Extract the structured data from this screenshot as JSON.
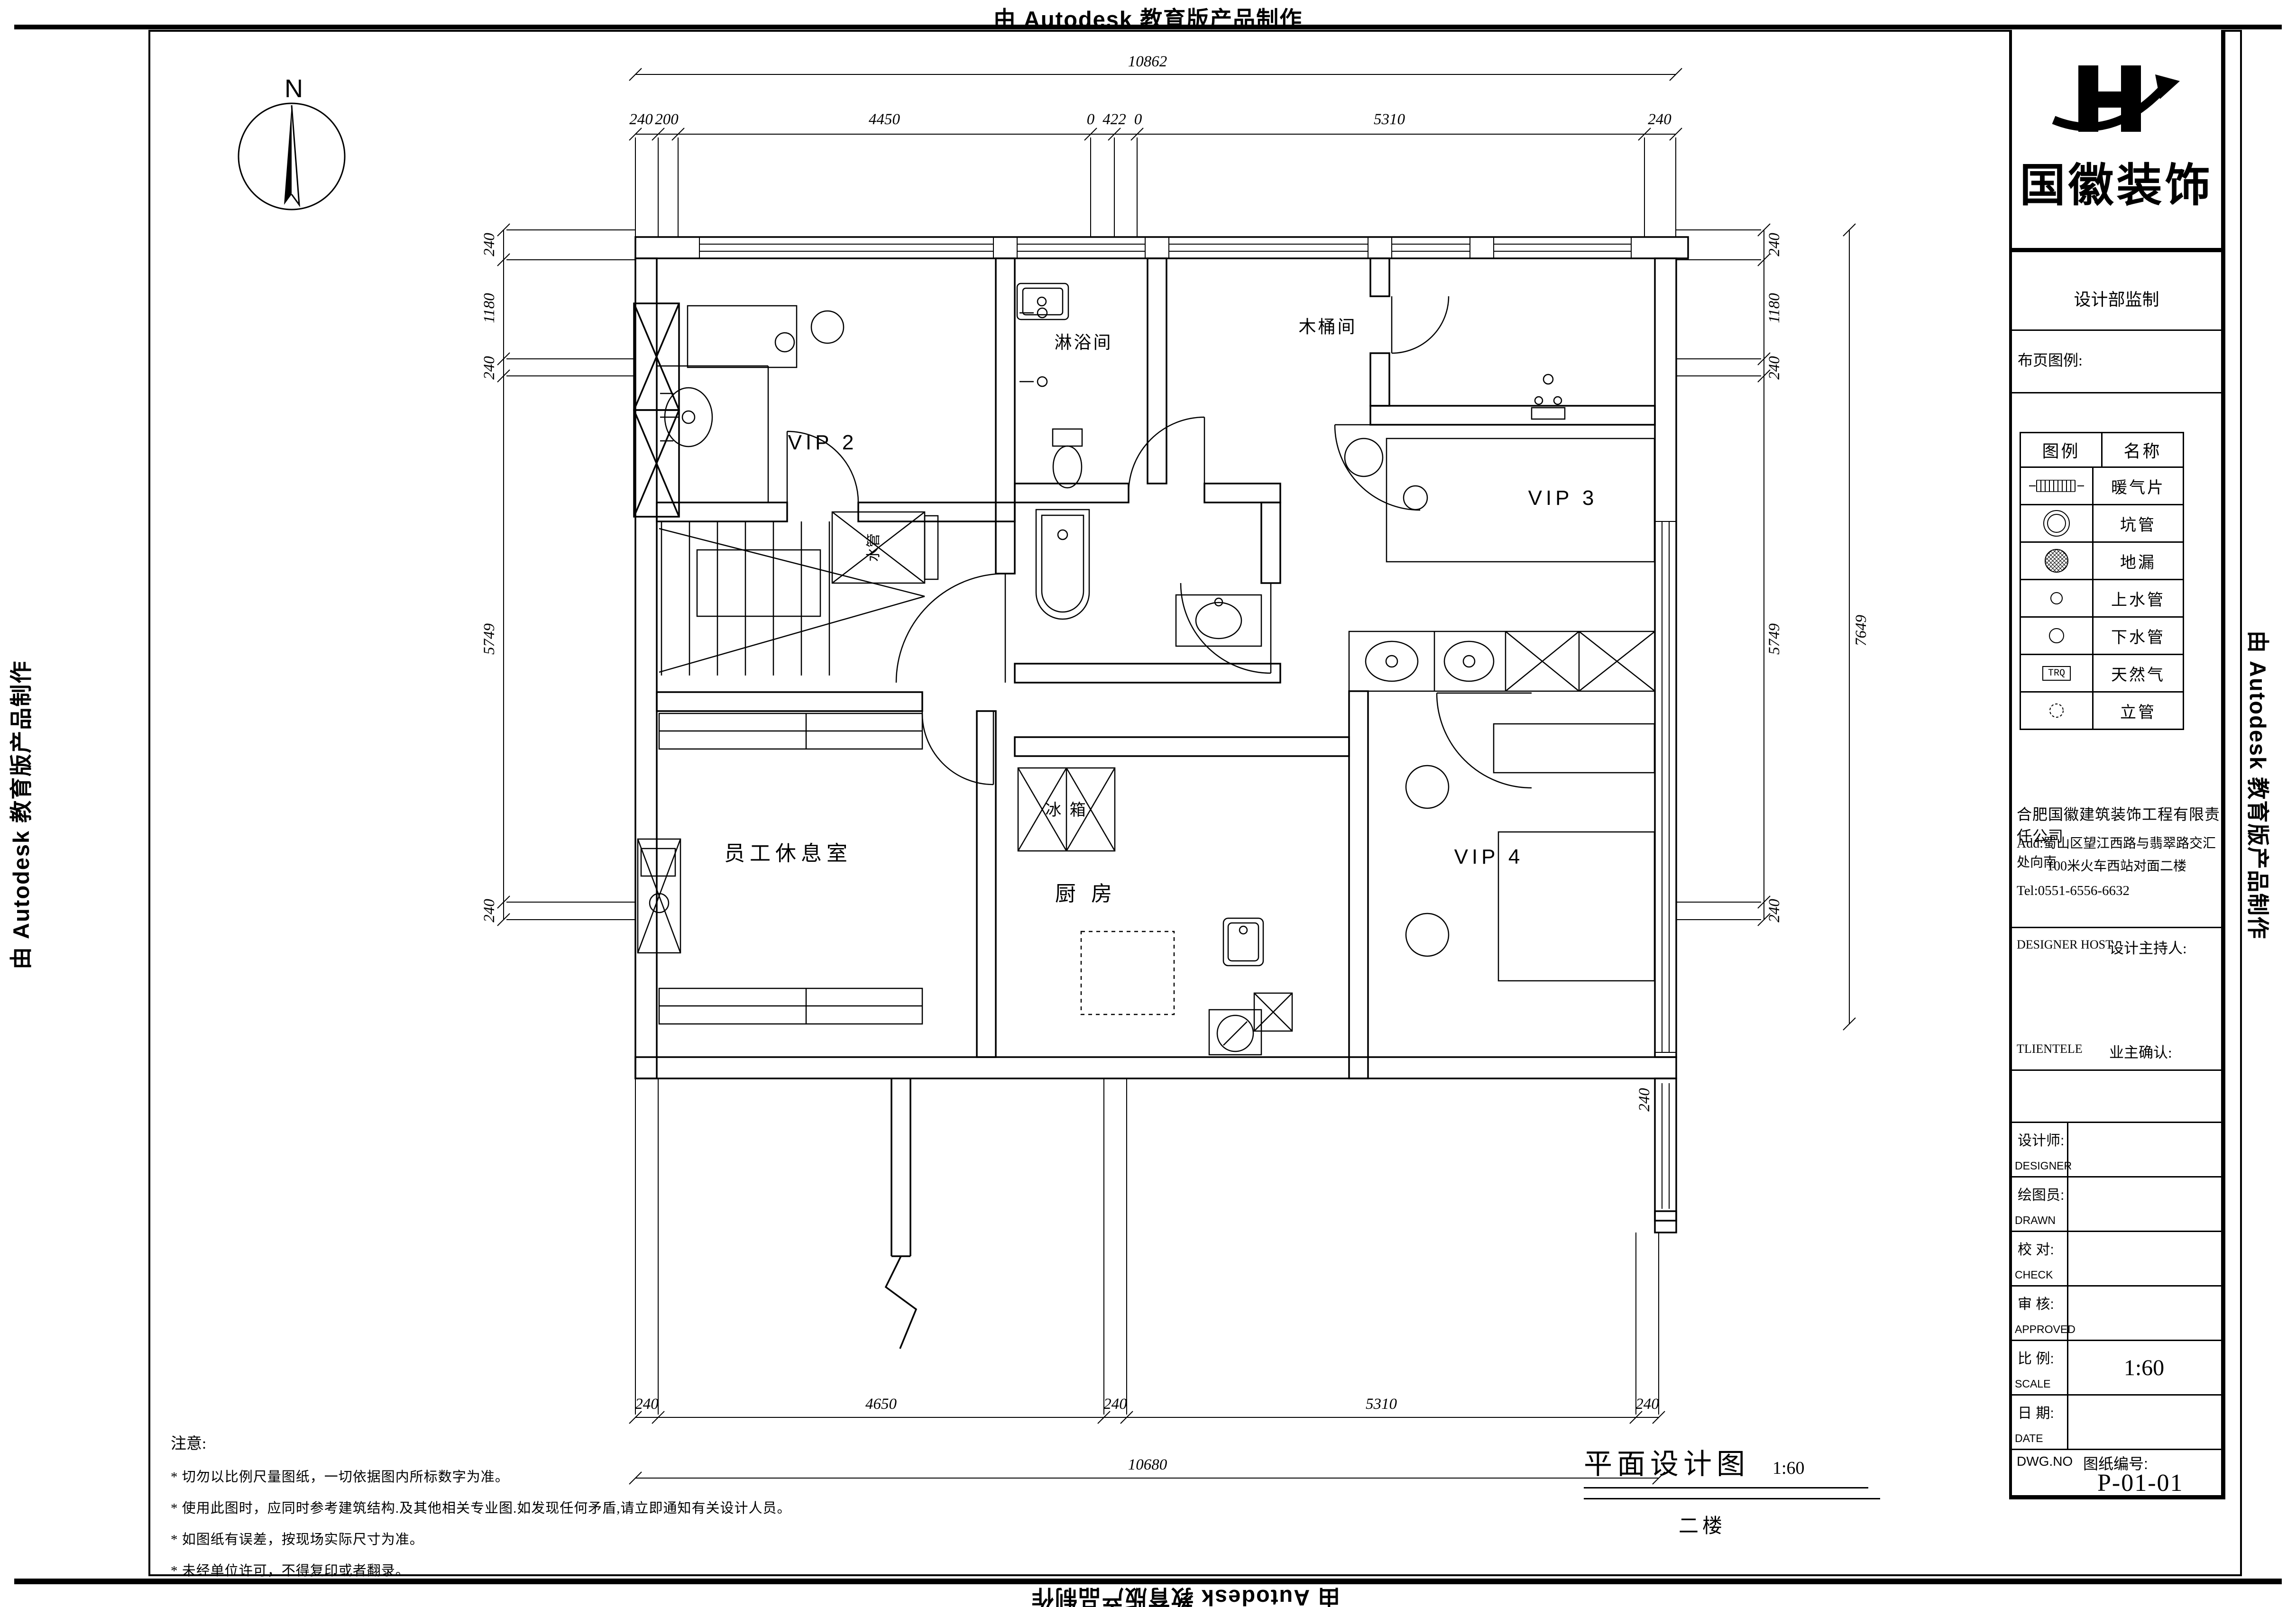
{
  "banner": {
    "text": "由 Autodesk 教育版产品制作"
  },
  "titleblock": {
    "brand": "国徽装饰",
    "supervision": "设计部监制",
    "legend_title": "布页图例:",
    "legend_headers": {
      "symbol": "图例",
      "name": "名称"
    },
    "legend_rows": [
      {
        "name": "暖气片"
      },
      {
        "name": "坑管"
      },
      {
        "name": "地漏"
      },
      {
        "name": "上水管"
      },
      {
        "name": "下水管"
      },
      {
        "name": "天然气",
        "symbol_text": "TRQ"
      },
      {
        "name": "立管"
      }
    ],
    "company": {
      "name": "合肥国徽建筑装饰工程有限责任公司",
      "addr1": "Add:蜀山区望江西路与翡翠路交汇处向南",
      "addr2": "100米火车西站对面二楼",
      "tel": "Tel:0551-6556-6632"
    },
    "host": {
      "en": "DESIGNER  HOST",
      "zh": "设计主持人:"
    },
    "client": {
      "en": "TLIENTELE",
      "zh": "业主确认:"
    },
    "rows": [
      {
        "zh": "设计师:",
        "en": "DESIGNER",
        "value": ""
      },
      {
        "zh": "绘图员:",
        "en": "DRAWN",
        "value": ""
      },
      {
        "zh": "校  对:",
        "en": "CHECK",
        "value": ""
      },
      {
        "zh": "审  核:",
        "en": "APPROVED",
        "value": ""
      },
      {
        "zh": "比  例:",
        "en": "SCALE",
        "value": "1:60"
      },
      {
        "zh": "日  期:",
        "en": "DATE",
        "value": ""
      }
    ],
    "dwg": {
      "en": "DWG.NO",
      "zh": "图纸编号:",
      "value": "P-01-01"
    }
  },
  "plan": {
    "north": "N",
    "rooms": {
      "vip2": "VIP 2",
      "shower": "淋浴间",
      "barrel": "木桶间",
      "vip3": "VIP 3",
      "vip4": "VIP 4",
      "staff": "员工休息室",
      "kitchen": "厨 房",
      "fridge": "冰 箱",
      "shaft": "水管"
    },
    "dims": {
      "top_total": "10862",
      "top": [
        "240",
        "200",
        "4450",
        "0",
        "422",
        "0",
        "5310",
        "240"
      ],
      "bottom": [
        "240",
        "4650",
        "240",
        "5310",
        "240"
      ],
      "bottom_total": "10680",
      "left": [
        "240",
        "1180",
        "240",
        "5749",
        "240"
      ],
      "right": [
        "240",
        "1180",
        "240",
        "5749",
        "240"
      ],
      "right_total": "7649",
      "stub": "240"
    }
  },
  "caption": {
    "title": "平面设计图",
    "scale": "1:60",
    "floor": "二楼"
  },
  "notes": {
    "title": "注意:",
    "items": [
      "* 切勿以比例尺量图纸，一切依据图内所标数字为准。",
      "* 使用此图时，应同时参考建筑结构.及其他相关专业图.如发现任何矛盾,请立即通知有关设计人员。",
      "* 如图纸有误差，按现场实际尺寸为准。",
      "* 未经单位许可，不得复印或者翻录。"
    ]
  }
}
